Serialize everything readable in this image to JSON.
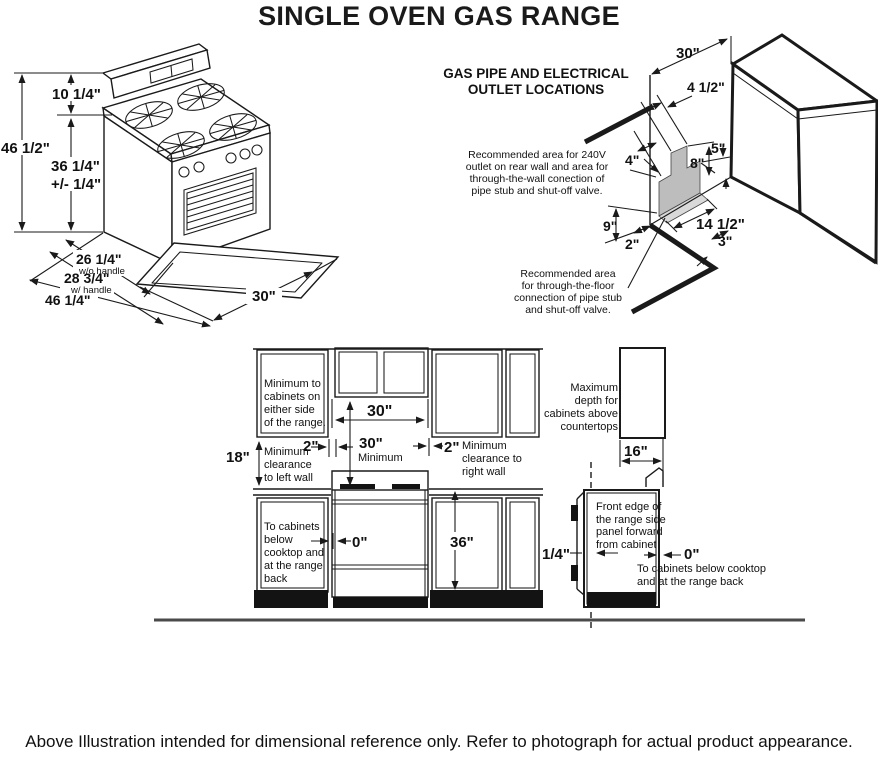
{
  "title": "SINGLE OVEN GAS RANGE",
  "caption": "Above Illustration intended for dimensional reference only. Refer to photograph for actual product appearance.",
  "colors": {
    "line": "#1a1a1a",
    "area_gray": "#bdbdbd",
    "floor_gray": "#d9d9d9"
  },
  "range_view": {
    "dims": {
      "backsplash_height": "10 1/4\"",
      "total_height": "46 1/2\"",
      "cooktop_height": "36 1/4\"",
      "cooktop_height_tol": "+/- 1/4\"",
      "depth_no_handle": "26 1/4\"",
      "note_no_handle": "w/o handle",
      "depth_with_handle": "28 3/4\"",
      "note_with_handle": "w/ handle",
      "depth_door_open": "46 1/4\"",
      "width": "30\""
    }
  },
  "gas_diagram": {
    "heading": "GAS PIPE AND ELECTRICAL\nOUTLET LOCATIONS",
    "note_wall": "Recommended area for 240V\noutlet on rear wall and area for\nthrough-the-wall conection of\npipe stub and shut-off valve.",
    "note_floor": "Recommended area\nfor through-the-floor\nconnection of pipe stub\nand shut-off valve.",
    "dims": {
      "opening_width": "30\"",
      "outlet_width": "4 1/2\"",
      "corner_height": "5\"",
      "left_offset": "4\"",
      "step_height": "8\"",
      "left_height": "9\"",
      "corner_offset": "2\"",
      "floor_length": "14 1/2\"",
      "floor_width": "3\""
    }
  },
  "installation_view": {
    "labels": {
      "min_side_cabinets": "Minimum to\ncabinets on\neither side\nof the range.",
      "min_left_wall": "Minimum\nclearance\nto left wall",
      "min_right_wall": "Minimum\nclearance to\nright wall",
      "below_cooktop": "To cabinets\nbelow\ncooktop and\nat the range\nback",
      "max_depth": "Maximum\ndepth for\ncabinets above\ncountertops",
      "front_edge": "Front edge of\nthe range side\npanel forward\nfrom cabinet",
      "below_cooktop_side": "To cabinets below cooktop\nand at the range back",
      "minimum": "Minimum"
    },
    "dims": {
      "cabinet_opening": "30\"",
      "vertical_clearance": "30\"",
      "left_gap": "2\"",
      "right_gap": "2\"",
      "cabinet_to_counter": "18\"",
      "zero_clearance": "0\"",
      "counter_height": "36\"",
      "upper_cabinet_depth": "16\"",
      "side_panel_offset": "1/4\"",
      "zero_back": "0\""
    }
  }
}
